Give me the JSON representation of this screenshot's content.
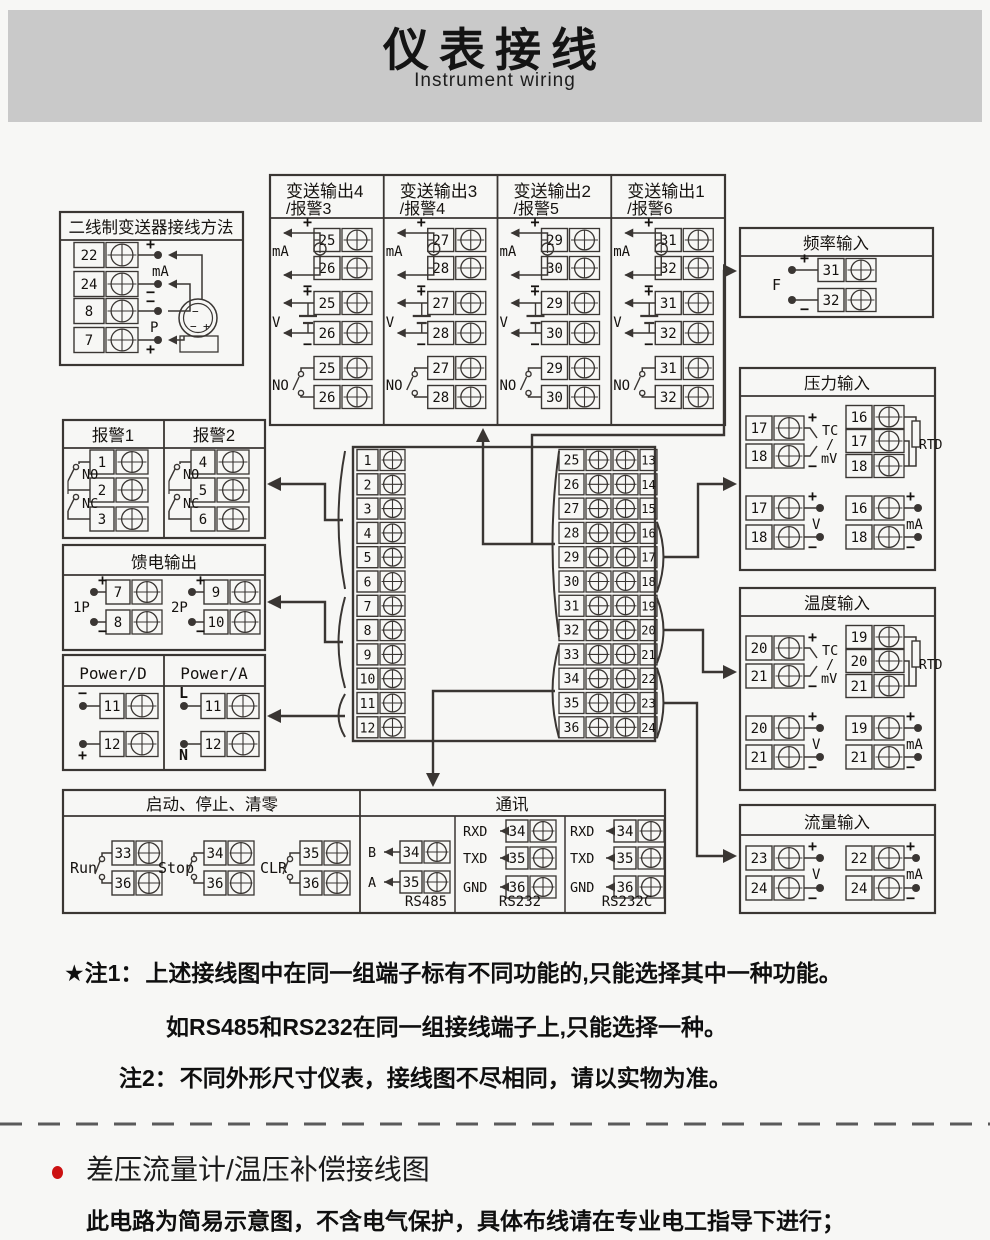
{
  "page": {
    "header_bg": "#c9c9c9",
    "bg": "#f7f7f5",
    "line": "#3a3633",
    "red": "#cc1111"
  },
  "header": {
    "title": "仪表接线",
    "subtitle": "Instrument wiring"
  },
  "two_wire": {
    "title": "二线制变送器接线方法",
    "rows": [
      {
        "n": "22",
        "sign": "+"
      },
      {
        "n": "24",
        "sign": "−"
      },
      {
        "n": "8",
        "sign": "−"
      },
      {
        "n": "7",
        "sign": "+"
      }
    ],
    "between": [
      "mA",
      "P"
    ],
    "tx_minus": "−",
    "tx_plus": "+"
  },
  "transmit": {
    "columns": [
      {
        "title": "变送输出4",
        "subtitle": "/报警3",
        "top": "25",
        "bot": "26"
      },
      {
        "title": "变送输出3",
        "subtitle": "/报警4",
        "top": "27",
        "bot": "28"
      },
      {
        "title": "变送输出2",
        "subtitle": "/报警5",
        "top": "29",
        "bot": "30"
      },
      {
        "title": "变送输出1",
        "subtitle": "/报警6",
        "top": "31",
        "bot": "32"
      }
    ],
    "ma": "mA",
    "v": "V",
    "no": "NO",
    "plus": "+",
    "minus": "−"
  },
  "freq": {
    "title": "频率输入",
    "label": "F",
    "rows": [
      {
        "n": "31",
        "sign": "+"
      },
      {
        "n": "32",
        "sign": "−"
      }
    ]
  },
  "alarm": {
    "columns": [
      {
        "title": "报警1",
        "t": [
          "1",
          "2",
          "3"
        ]
      },
      {
        "title": "报警2",
        "t": [
          "4",
          "5",
          "6"
        ]
      }
    ],
    "no": "NO",
    "nc": "NC"
  },
  "feed": {
    "title": "馈电输出",
    "groups": [
      {
        "label": "1P",
        "top": "7",
        "bot": "8"
      },
      {
        "label": "2P",
        "top": "9",
        "bot": "10"
      }
    ],
    "plus": "+",
    "minus": "−"
  },
  "power": {
    "columns": [
      {
        "title": "Power/D",
        "rows": [
          {
            "n": "11",
            "sign": "−"
          },
          {
            "n": "12",
            "sign": "+"
          }
        ]
      },
      {
        "title": "Power/A",
        "rows": [
          {
            "n": "11",
            "sign": "L"
          },
          {
            "n": "12",
            "sign": "N"
          }
        ]
      }
    ]
  },
  "pressure": {
    "title": "压力输入",
    "tc": {
      "top": "17",
      "bot": "18",
      "label": [
        "TC",
        "/",
        "mV"
      ]
    },
    "rtd": {
      "t": [
        "16",
        "17",
        "18"
      ],
      "label": "RTD"
    },
    "v": {
      "top": "17",
      "bot": "18",
      "label": "V"
    },
    "ma": {
      "top": "16",
      "bot": "18",
      "label": "mA"
    },
    "plus": "+",
    "minus": "−"
  },
  "temperature": {
    "title": "温度输入",
    "tc": {
      "top": "20",
      "bot": "21",
      "label": [
        "TC",
        "/",
        "mV"
      ]
    },
    "rtd": {
      "t": [
        "19",
        "20",
        "21"
      ],
      "label": "RTD"
    },
    "v": {
      "top": "20",
      "bot": "21",
      "label": "V"
    },
    "ma": {
      "top": "19",
      "bot": "21",
      "label": "mA"
    },
    "plus": "+",
    "minus": "−"
  },
  "flow": {
    "title": "流量输入",
    "v": {
      "top": "23",
      "bot": "24",
      "label": "V"
    },
    "ma": {
      "top": "22",
      "bot": "24",
      "label": "mA"
    },
    "plus": "+",
    "minus": "−"
  },
  "central": {
    "left": [
      "1",
      "2",
      "3",
      "4",
      "5",
      "6",
      "7",
      "8",
      "9",
      "10",
      "11",
      "12"
    ],
    "pairs": [
      [
        "25",
        "13"
      ],
      [
        "26",
        "14"
      ],
      [
        "27",
        "15"
      ],
      [
        "28",
        "16"
      ],
      [
        "29",
        "17"
      ],
      [
        "30",
        "18"
      ],
      [
        "31",
        "19"
      ],
      [
        "32",
        "20"
      ],
      [
        "33",
        "21"
      ],
      [
        "34",
        "22"
      ],
      [
        "35",
        "23"
      ],
      [
        "36",
        "24"
      ]
    ]
  },
  "startstop": {
    "title": "启动、停止、清零",
    "switches": [
      {
        "label": "Run",
        "top": "33",
        "bot": "36"
      },
      {
        "label": "Stop",
        "top": "34",
        "bot": "36"
      },
      {
        "label": "CLR",
        "top": "35",
        "bot": "36"
      }
    ]
  },
  "comm": {
    "title": "通讯",
    "groups": [
      {
        "label": "RS485",
        "rows": [
          {
            "sig": "B",
            "n": "34"
          },
          {
            "sig": "A",
            "n": "35"
          }
        ]
      },
      {
        "label": "RS232",
        "rows": [
          {
            "sig": "RXD",
            "n": "34"
          },
          {
            "sig": "TXD",
            "n": "35"
          },
          {
            "sig": "GND",
            "n": "36"
          }
        ]
      },
      {
        "label": "RS232C",
        "rows": [
          {
            "sig": "RXD",
            "n": "34"
          },
          {
            "sig": "TXD",
            "n": "35"
          },
          {
            "sig": "GND",
            "n": "36"
          }
        ]
      }
    ]
  },
  "notes": {
    "n1_head": "★注1：",
    "n1_line1": "上述接线图中在同一组端子标有不同功能的,只能选择其中一种功能。",
    "n1_line2": "如RS485和RS232在同一组接线端子上,只能选择一种。",
    "n2_head": "注2：",
    "n2_text": "不同外形尺寸仪表，接线图不尽相同，请以实物为准。"
  },
  "bottom": {
    "heading": "差压流量计/温压补偿接线图",
    "caution": "此电路为简易示意图，不含电气保护，具体布线请在专业电工指导下进行；"
  }
}
